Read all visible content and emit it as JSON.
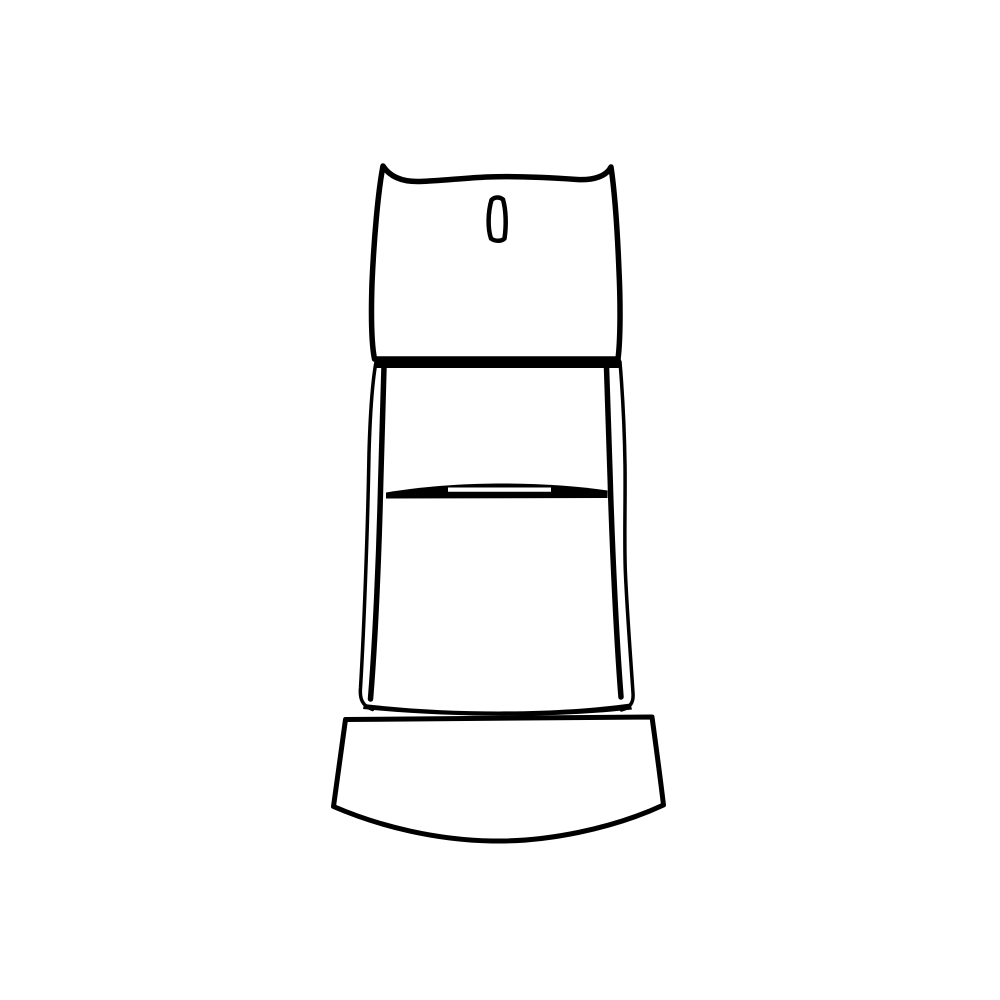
{
  "canvas": {
    "width": 1000,
    "height": 1000,
    "background_color": "#ffffff"
  },
  "illustration": {
    "label": "black-and-white line drawing of a pedestal-style object: slotted head, tapered column with crossbar slit, flared curved base",
    "stroke_color": "#000000",
    "fill_color": "#ffffff",
    "shapes": [
      {
        "name": "head-outline",
        "d": "M 383 166 C 378 192 374 238 372 283 C 371 314 371.5 344 374.5 359 L 618 359 C 620.5 339 620.5 303 619 271 C 617.5 233 615 194 611 167 C 606.5 176 594 180.5 577 179.5 C 548 177.5 514 176 487 177 C 465 178 438 181 420 181.5 C 403 182 390 177 383 166 Z",
        "fill": "#ffffff",
        "stroke": "#000000",
        "strokeWidth": 5.5
      },
      {
        "name": "head-slot",
        "d": "M 491.5 200 C 488 212 487.5 228 491 238.5 C 495 241.5 501.5 241.5 504.5 238.5 C 506.5 225 506 210 503 199.5 C 499.5 196.5 494.5 197 491.5 200 Z",
        "fill": "#ffffff",
        "stroke": "#000000",
        "strokeWidth": 4.5
      },
      {
        "name": "shoulder-bar",
        "d": "M 376 359.5 L 621 359.5 L 622 368 L 375 368 Z",
        "fill": "#000000",
        "stroke": null,
        "strokeWidth": 0
      },
      {
        "name": "left-inner-rail",
        "d": "M 384 367 C 382.5 415 381.5 452 380.5 490 C 379 553 375.5 638 370.5 699",
        "fill": null,
        "stroke": "#000000",
        "strokeWidth": 5.5
      },
      {
        "name": "right-inner-rail",
        "d": "M 606.5 367 C 608 415 609.5 452 610.5 490 C 612.5 553 616.5 640 621 697",
        "fill": null,
        "stroke": "#000000",
        "strokeWidth": 5.5
      },
      {
        "name": "left-outer-contour",
        "d": "M 376 362 C 372 384 370 418 369 453 C 367.5 540 363.5 638 360.5 688 C 359.5 699 362.5 706 372.5 709.5",
        "fill": null,
        "stroke": "#000000",
        "strokeWidth": 3.5
      },
      {
        "name": "right-outer-contour",
        "d": "M 620 362 C 623 398 624.5 432 625 465 C 625.5 505 624 545 625.5 575 C 627.5 618 631 662 633 693 C 633.8 703 630 707.5 621.5 710",
        "fill": null,
        "stroke": "#000000",
        "strokeWidth": 3.5
      },
      {
        "name": "crossbar-band",
        "d": "M 386 492.5 C 432 485 472 483.5 502 483.5 C 541 483.5 577 486 607.5 490.5 L 607.5 498 L 386 498.5 Z",
        "fill": "#000000",
        "stroke": null,
        "strokeWidth": 0
      },
      {
        "name": "crossbar-slot-highlight",
        "d": "M 448 487.5 L 551 487.5 L 551 491.8 L 448 491.8 Z",
        "fill": "#ffffff",
        "stroke": null,
        "strokeWidth": 0
      },
      {
        "name": "base-outline",
        "d": "M 345.5 719.5 L 652 717 C 656 746 660 776 663.5 805 C 612 829 546 842 492 841 C 437 840 381 827 333.5 806.5 C 337.5 777.5 341.5 748.5 345.5 719.5 Z",
        "fill": "#ffffff",
        "stroke": "#000000",
        "strokeWidth": 5
      },
      {
        "name": "column-bottom-band",
        "d": "M 364 704 C 450 714 555 714 630.5 703.5 L 632 709.5 C 556 718 452 718 363 709 Z",
        "fill": "#000000",
        "stroke": null,
        "strokeWidth": 0
      }
    ]
  }
}
